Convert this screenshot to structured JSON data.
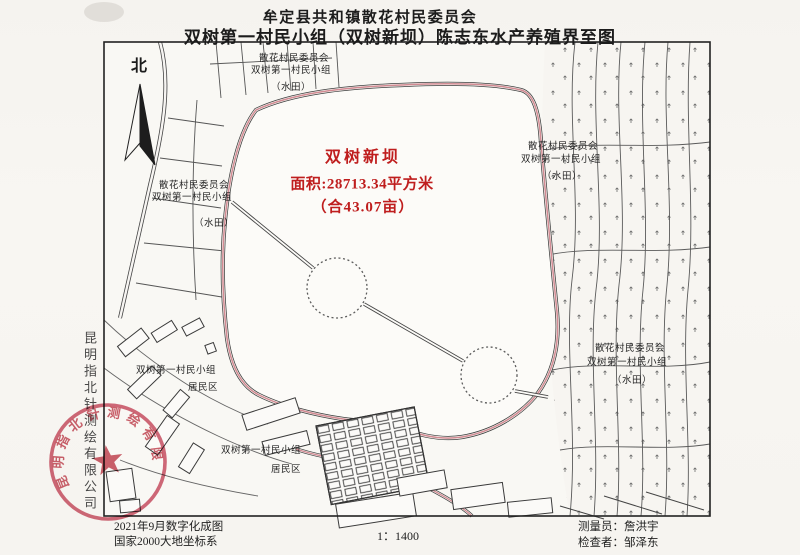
{
  "document": {
    "title_line1": "牟定县共和镇散花村民委员会",
    "title_line2": "双树第一村民小组（双树新坝）陈志东水产养殖界至图"
  },
  "map": {
    "north_label": "北",
    "scale": "1：1400",
    "highlight": {
      "name": "双树新坝",
      "area_line": "面积:28713.34平方米",
      "area_mu_line": "（合43.07亩）",
      "color": "#bf1e1e"
    },
    "field_label": {
      "line1": "散花村民委员会",
      "line2": "双树第一村民小组",
      "line3": "（水田）"
    },
    "residential_label": {
      "line1": "双树第一村民小组",
      "line2": "居民区"
    },
    "boundary_color": "#d28b93"
  },
  "footer": {
    "left_line1": "2021年9月数字化成图",
    "left_line2": "国家2000大地坐标系",
    "right_line1": "测量员：詹洪宇",
    "right_line2": "检查者：邹泽东"
  },
  "stamp": {
    "company": "昆明指北针测绘有限公司",
    "color": "#c2404f"
  },
  "side_company": "昆明指北针测绘有限公司"
}
